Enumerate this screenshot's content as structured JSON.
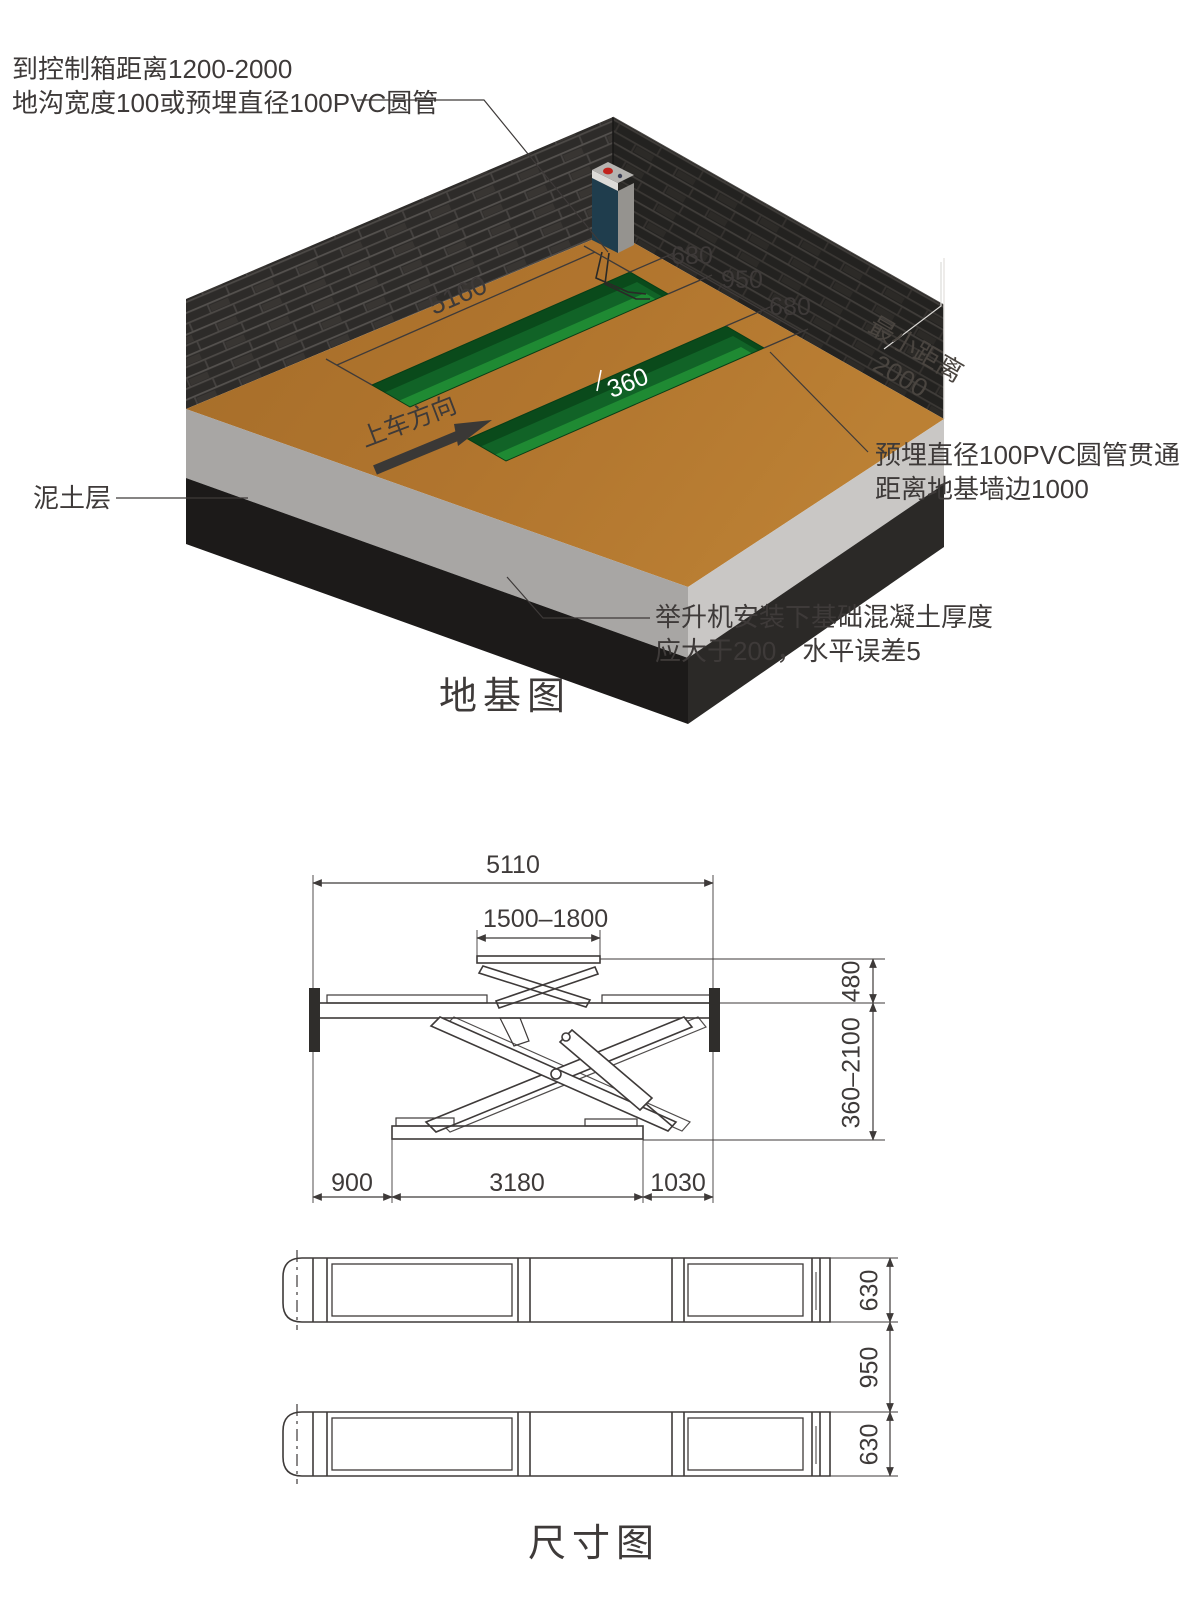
{
  "foundation": {
    "title": "地基图",
    "ann_control_line1": "到控制箱距离1200-2000",
    "ann_control_line2": "地沟宽度100或预埋直径100PVC圆管",
    "ann_soil": "泥土层",
    "ann_pvc_line1": "预埋直径100PVC圆管贯通",
    "ann_pvc_line2": "距离地基墙边1000",
    "ann_concrete_line1": "举升机安装下基础混凝土厚度",
    "ann_concrete_line2": "应大于200，水平误差5",
    "min_distance_line1": "最小距离",
    "min_distance_line2": "2000",
    "drive_direction": "上车方向",
    "dims": {
      "pit_length": "5160",
      "pit_width_left": "680",
      "pit_gap": "950",
      "pit_width_right": "680",
      "pit_depth": "360"
    }
  },
  "dimension_drawing": {
    "title": "尺寸图",
    "side": {
      "total_length": "5110",
      "runway_platform": "1500–1800",
      "platform_height": "480",
      "height_range": "360–2100",
      "front_overhang": "900",
      "base_length": "3180",
      "rear_overhang": "1030"
    },
    "plan": {
      "platform_width_top": "630",
      "gap": "950",
      "platform_width_bottom": "630"
    }
  },
  "colors": {
    "line": "#3e3a39",
    "floor": "#b1752e",
    "pit_bright": "#1f8a33",
    "pit_dark": "#0a4a1b",
    "wall": "#2c2a28",
    "concrete_light": "#c9c7c5",
    "concrete_mid": "#a8a6a4",
    "soil": "#1c1a19",
    "cabinet": "#1f3d4d"
  }
}
